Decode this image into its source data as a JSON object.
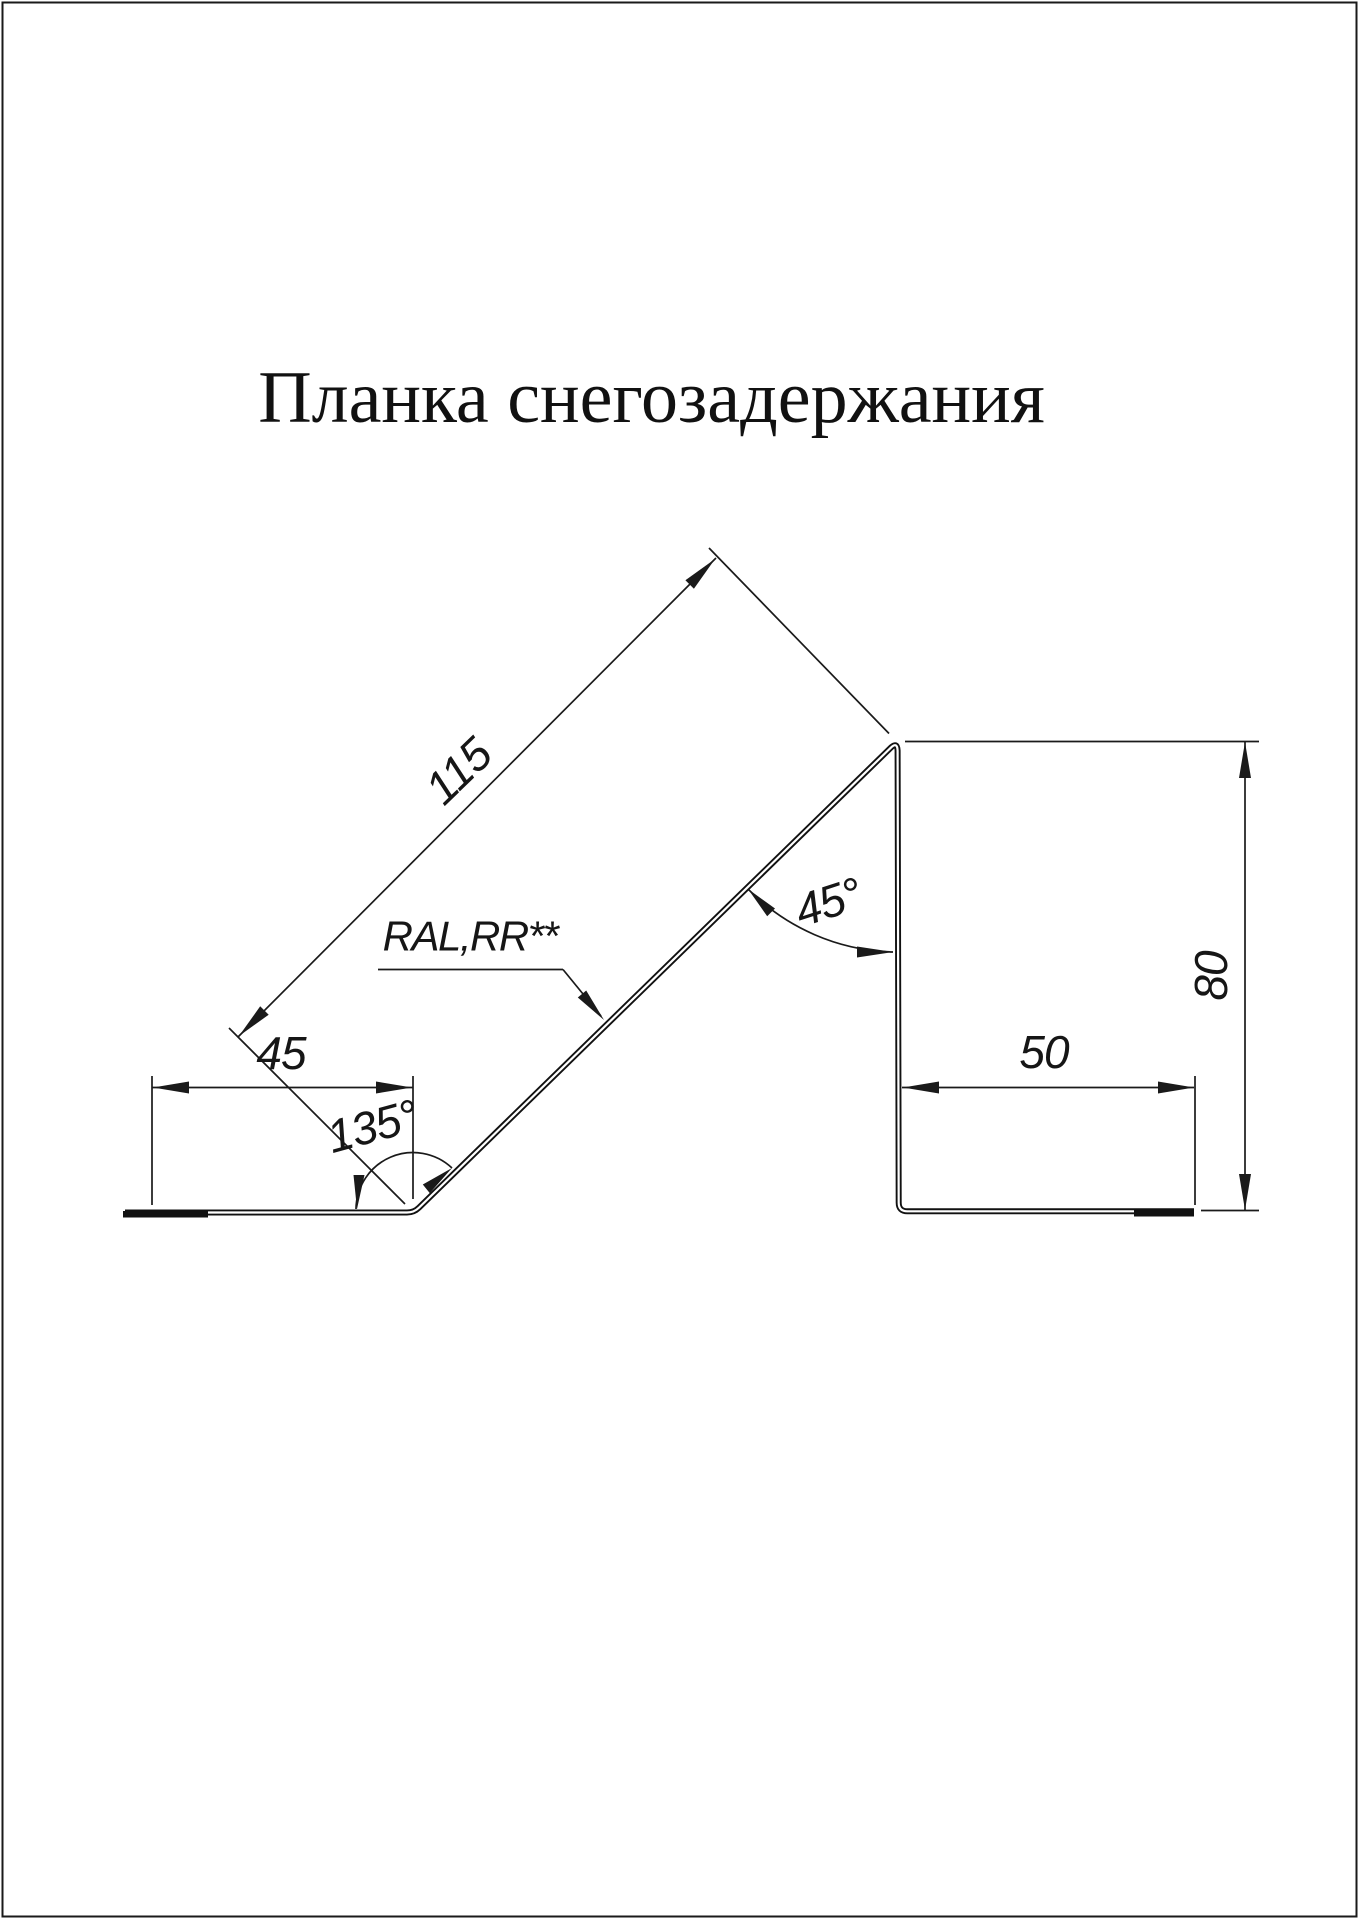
{
  "page": {
    "title": "Планка снегозадержания"
  },
  "drawing": {
    "part": "snow-retention-bar-profile",
    "dimensions": {
      "diagonal_length": "115",
      "left_flange_width": "45",
      "right_flange_width": "50",
      "height": "80",
      "bottom_bend_angle": "135°",
      "top_bend_angle": "45°"
    },
    "material_label": "RAL,RR**"
  },
  "colors": {
    "line": "#1a1a1a",
    "background": "#ffffff"
  }
}
